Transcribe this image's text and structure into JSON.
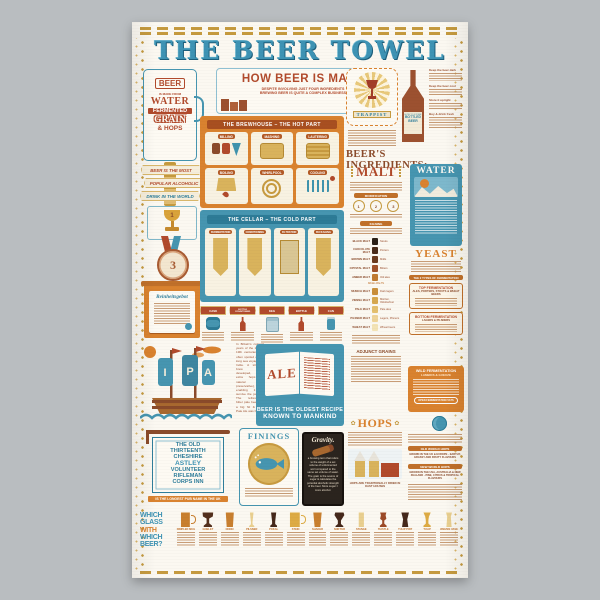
{
  "palette": {
    "blue": "#4695b0",
    "orange": "#d9822f",
    "rust": "#b14a2c",
    "gold": "#c59a3f",
    "cream": "#f8f2e2",
    "brown_text": "#8a4a2a",
    "towel_cloth": "#fbf8f1",
    "photo_bg": "#b9bdc0",
    "chalkboard": "#2b241e"
  },
  "towel": {
    "title": "THE BEER TOWEL",
    "left": {
      "mug": {
        "l1": "BEER",
        "l2": "IS MADE FROM",
        "l3": "WATER",
        "l4": "FERMENTED",
        "l5": "GRAIN",
        "l6": "& HOPS"
      },
      "ribbons": {
        "r1": "BEER IS THE MOST",
        "r2": "POPULAR ALCOHOLIC",
        "r3": "DRINK IN THE WORLD"
      },
      "trophy_number": "1",
      "medal_number": "3",
      "scroll_title": "Reinheitsgebot",
      "pubsign": {
        "l1": "THE OLD",
        "l2": "THIRTEENTH",
        "l3": "CHESHIRE",
        "l4": "ASTLEY",
        "l5": "VOLUNTEER",
        "l6": "RIFLEMAN",
        "l7": "CORPS INN",
        "caption": "IS THE LONGEST PUB NAME IN THE UK"
      }
    },
    "how": {
      "title": "HOW BEER IS MADE",
      "sub1": "DESPITE INVOLVING JUST FOUR INGREDIENTS",
      "sub2": "BREWING BEER IS QUITE A COMPLEX BUSINESS"
    },
    "brewhouse": {
      "title": "THE BREWHOUSE – THE HOT PART",
      "steps": [
        {
          "label": "MILLING"
        },
        {
          "label": "MASHING"
        },
        {
          "label": "LAUTERING"
        },
        {
          "label": "BOILING"
        },
        {
          "label": "WHIRLPOOL"
        },
        {
          "label": "COOLING"
        }
      ]
    },
    "cellar": {
      "title": "THE CELLAR – THE COLD PART",
      "steps": [
        {
          "label": "FERMENTATION"
        },
        {
          "label": "CONDITIONING"
        },
        {
          "label": "FILTRATION"
        },
        {
          "label": "PACKAGING"
        }
      ]
    },
    "packaging": {
      "items": [
        {
          "label": "CASK"
        },
        {
          "label": "BOTTLE CONDITIONED"
        },
        {
          "label": "KEG"
        },
        {
          "label": "BOTTLE"
        },
        {
          "label": "CAN"
        }
      ]
    },
    "trappist": {
      "label": "TRAPPIST"
    },
    "storage": {
      "label_top": "HOW TO STORE",
      "label_main": "BOTTLED BEER",
      "tips": [
        {
          "h": "Keep the beer dark"
        },
        {
          "h": "Keep the beer cool"
        },
        {
          "h": "Store it upright"
        },
        {
          "h": "Buy & drink fresh"
        }
      ]
    },
    "ingredients": {
      "heading": "BEER'S INGREDIENTS:",
      "malt": {
        "word": "MALT",
        "banner1": "MODIFICATION",
        "banner2": "KILNING",
        "step1": "1",
        "step2": "2",
        "step3": "3",
        "divider": "BASE MALTS",
        "adjunct": "ADJUNCT GRAINS",
        "swatches": [
          "#2b2118",
          "#4a2c1a",
          "#6b3b1e",
          "#a0522a",
          "#c07a30",
          "#c98f3a",
          "#d6a84e",
          "#e3bf6e",
          "#eed398",
          "#f3e3b5"
        ],
        "table": [
          {
            "name": "BLACK MALT",
            "style": "Stouts"
          },
          {
            "name": "CHOCOLATE MALT",
            "style": "Porters"
          },
          {
            "name": "BROWN MALT",
            "style": "Milds"
          },
          {
            "name": "CRYSTAL MALT",
            "style": "Bitters"
          },
          {
            "name": "AMBER MALT",
            "style": "Old ales"
          },
          {
            "name": "MUNICH MALT",
            "style": "Dark lagers"
          },
          {
            "name": "VIENNA MALT",
            "style": "Märzen, Oktoberfest"
          },
          {
            "name": "PALE MALT",
            "style": "Pale ales"
          },
          {
            "name": "PILSNER MALT",
            "style": "Lagers, Pilsners"
          },
          {
            "name": "WHEAT MALT",
            "style": "Wheat beers"
          }
        ]
      },
      "water": {
        "word": "WATER"
      },
      "yeast": {
        "word": "YEAST",
        "banner": "THE 2 TYPES OF FERMENTATION",
        "top": {
          "h": "TOP FERMENTATION",
          "s": "ALES, PORTERS, STOUTS & WHEAT BEERS"
        },
        "bottom": {
          "h": "BOTTOM FERMENTATION",
          "s": "LAGERS & PILSNERS"
        }
      },
      "wild": {
        "h": "WILD FERMENTATION",
        "s": "LAMBICS & GUEUZE",
        "pill": "OPEN FERMENTATION VATS"
      },
      "hops": {
        "word": "HOPS",
        "oast_caption": "HOPS ARE TRADITIONALLY DRIED IN OAST HOUSES",
        "old": {
          "h": "OLD WORLD HOPS",
          "s1": "GROWN IN THE UK & EUROPE",
          "s2": "EARTHY, GRASSY AND FRUITY FLAVOURS"
        },
        "new": {
          "h": "NEW WORLD HOPS",
          "s1": "GROWN IN THE USA, AUSTRALIA & NEW ZEALAND",
          "s2": "PINE, CITRUS & TROPICAL FLAVOURS"
        }
      }
    },
    "ipa": {
      "sails": [
        "I",
        "P",
        "A"
      ],
      "story": "In Britain's colonial years of the 18th & 19th centuries, ale often spoiled during long sea voyages to India. A stronger brew was developed, with extra hops (a natural preservative), enabling it to survive the journey. The refreshingly bitter pale beer was a big hit & India Pale Ale was born."
    },
    "ale": {
      "word": "ALE",
      "caption1": "BEER IS THE OLDEST RECIPE",
      "caption2": "KNOWN TO MANKIND"
    },
    "finings": {
      "word": "FININGS"
    },
    "gravity": {
      "word": "Gravity.",
      "text": "a brewing term that refers to the weight of a set volume of unfermented wort compared to the same set volume of water. The grain is the source of sugar & calculates the potential alcoholic strength of the beer. More sugar = more alcohol."
    },
    "glasses": {
      "h1": "WHICH",
      "h2": "GLASS",
      "h3": "WITH",
      "h4": "WHICH",
      "h5": "BEER?",
      "items": [
        {
          "name": "DIMPLED MUG"
        },
        {
          "name": "GOBLET"
        },
        {
          "name": "NONIC"
        },
        {
          "name": "PILSNER"
        },
        {
          "name": "POKAL"
        },
        {
          "name": "STEIN"
        },
        {
          "name": "SHAKER"
        },
        {
          "name": "SNIFTER"
        },
        {
          "name": "STANGE"
        },
        {
          "name": "THISTLE"
        },
        {
          "name": "TULIP PINT"
        },
        {
          "name": "TULIP"
        },
        {
          "name": "WEIZEN VASE"
        }
      ]
    }
  }
}
